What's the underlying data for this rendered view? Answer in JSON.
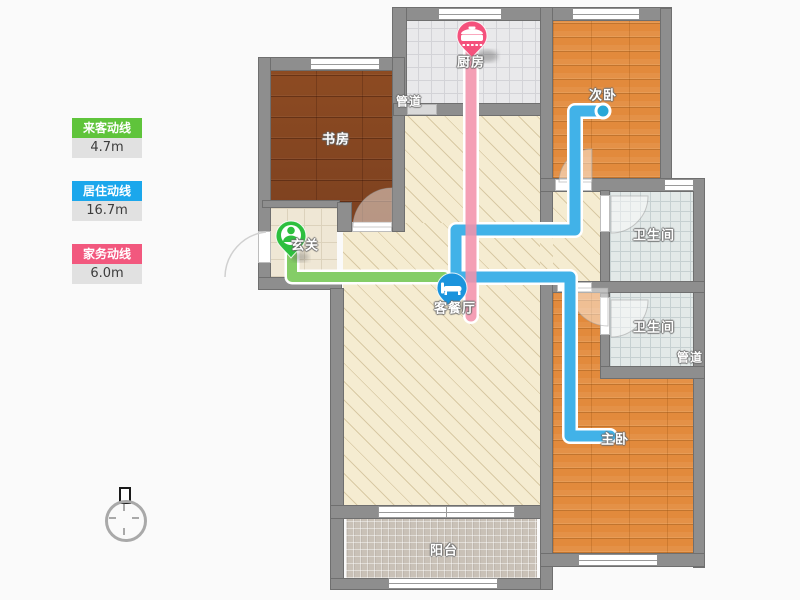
{
  "legend": {
    "items": [
      {
        "id": "visitor",
        "label": "来客动线",
        "value": "4.7m",
        "color": "#5fc43b"
      },
      {
        "id": "resident",
        "label": "居住动线",
        "value": "16.7m",
        "color": "#1ba7ec"
      },
      {
        "id": "housework",
        "label": "家务动线",
        "value": "6.0m",
        "color": "#f2587e"
      }
    ]
  },
  "rooms": {
    "study": {
      "label": "书房"
    },
    "kitchen": {
      "label": "厨房"
    },
    "duct_top": {
      "label": "管道"
    },
    "second_bedroom": {
      "label": "次卧"
    },
    "bathroom1": {
      "label": "卫生间"
    },
    "bathroom2": {
      "label": "卫生间"
    },
    "duct_right": {
      "label": "管道"
    },
    "master_bedroom": {
      "label": "主卧"
    },
    "balcony": {
      "label": "阳台"
    },
    "entry": {
      "label": "玄关"
    },
    "living_dining": {
      "label": "客餐厅"
    }
  },
  "markers": {
    "kitchen_pin": {
      "icon": "pot-icon",
      "color": "#f4517c"
    },
    "entry_pin": {
      "icon": "person-icon",
      "color": "#2dbf3e"
    },
    "living_pin": {
      "icon": "bed-icon",
      "color": "#1b94dd"
    },
    "bedroom_endpoint": {
      "icon": "dot",
      "color": "#28a7d7"
    }
  },
  "route_colors": {
    "visitor": "#84cd67",
    "resident": "#41b2e8",
    "housework": "#f392ab"
  }
}
